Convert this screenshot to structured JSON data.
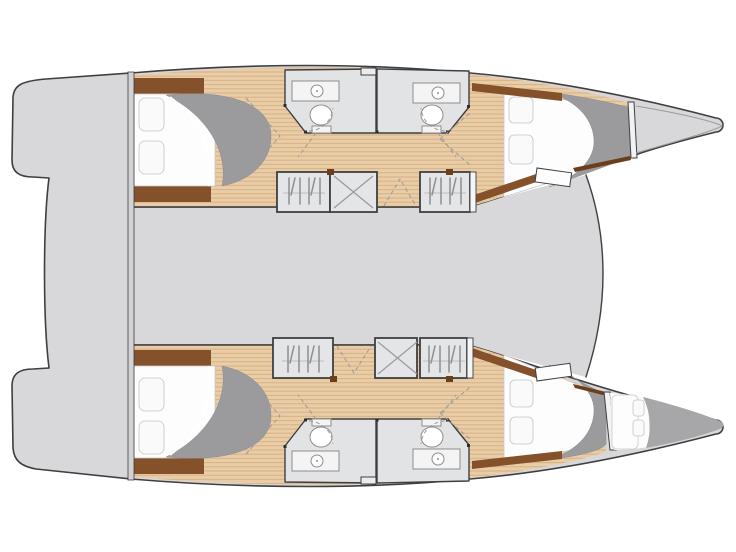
{
  "title": "Catamaran yacht interior layout floor plan, top view",
  "canvas": {
    "width": 736,
    "height": 552
  },
  "colors": {
    "background": "#ffffff",
    "deck": "#d8d8da",
    "outline": "#3f3f41",
    "wood": "#e9cda6",
    "wood_line": "#d4ad83",
    "trim_brown": "#84512a",
    "trim_brown_dark": "#6b3e1c",
    "duvet_gray": "#9b9b9d",
    "bow_shade": "#a7a7a9",
    "bathroom_floor": "#e2e3e5",
    "locker_fill": "#e4e5e7",
    "fixture_line": "#8e8e8e",
    "mattress": "#fdfdfd",
    "pillow": "#fafafa",
    "dash_line": "#9a9a9a",
    "transom": "#d2d2d4",
    "inset_line": "#9a9a9a"
  },
  "structure": {
    "upper_hull": {
      "rooms": [
        "aft-double-cabin",
        "twin-bathrooms",
        "forward-double-cabin",
        "bow-locker"
      ],
      "lockers": [
        "wardrobe",
        "companionway-stairs",
        "wardrobe"
      ]
    },
    "lower_hull": {
      "rooms": [
        "aft-double-cabin",
        "twin-bathrooms",
        "forward-double-cabin",
        "forepeak-berth"
      ],
      "lockers": [
        "wardrobe",
        "companionway-stairs",
        "wardrobe"
      ]
    },
    "center": [
      "stern-platform",
      "bridge-deck",
      "trampoline-area"
    ]
  }
}
